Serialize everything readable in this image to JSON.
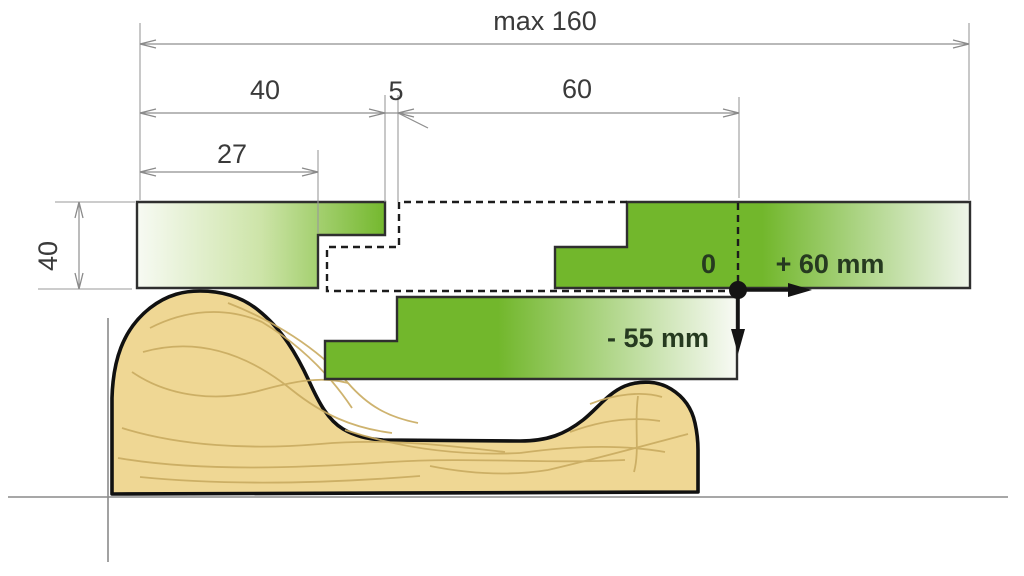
{
  "diagram": {
    "type": "technical-dimension-diagram",
    "description": "Cross-section drawing of a moulding cutter setup over a wooden profile with travel ranges",
    "labels": {
      "max_width": "max 160",
      "seg_40": "40",
      "seg_5": "5",
      "seg_60": "60",
      "seg_27": "27",
      "height_40": "40",
      "origin_zero": "0",
      "travel_right": "+ 60 mm",
      "travel_down": "- 55 mm"
    },
    "dimensions_mm": {
      "max_width": 160,
      "left_block_width": 40,
      "gap": 5,
      "right_span": 60,
      "left_step_width": 27,
      "block_height": 40,
      "travel_right_mm": 60,
      "travel_down_mm": -55
    },
    "colors": {
      "green": "#74b82e",
      "green_light": "#f4f8ee",
      "wood": "#efd794",
      "wood_grain": "#c9ab60",
      "outline": "#141414",
      "dim_line": "#8f8f8f",
      "dim_text": "#3a3a3a",
      "annotation_text": "#263a20"
    }
  }
}
